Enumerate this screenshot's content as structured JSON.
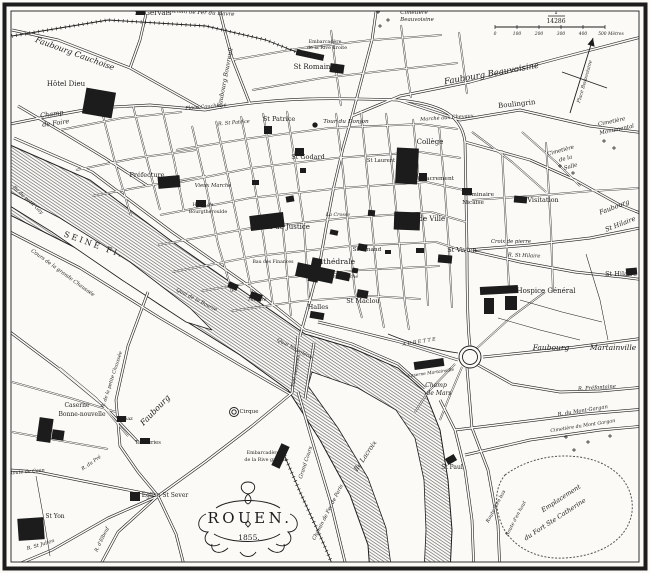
{
  "title": {
    "name": "ROUEN.",
    "year": "1855."
  },
  "scale": {
    "numerator": "1",
    "denominator": "14286",
    "ticks": [
      "0",
      "100",
      "200",
      "300",
      "400",
      "500 Mètres"
    ],
    "bar": {
      "x0": 495,
      "y": 27,
      "step": 22
    }
  },
  "colors": {
    "ink": "#1c1c1c",
    "paper": "#fbfaf6",
    "water_line": "#4a4a4a"
  },
  "compass": {
    "needle": "M570,113 L593,38",
    "cross": "M562,72 L607,88",
    "head": "M593,38 L594.6,46.7 L587.5,44.5 Z"
  },
  "river": {
    "main": "M10,145 L90,180 L170,240 L250,296 L305,334 L352,348 L398,368 L425,392 L440,430 L448,480 L452,530 L450,573 L370,573 L368,545 L350,495 L320,440 L288,390 L240,355 L160,305 L80,250 L10,215 Z",
    "islands": [
      "M312,372 L358,388 L396,410 L415,438 L424,480 L426,530 L424,573 L392,573 L386,528 L368,478 L338,428 L308,386 Z",
      "M10,192 L60,218 L130,262 L190,308 L212,330 L186,322 L122,280 L52,232 L10,206 Z"
    ],
    "aubette": "M388,334 C412,344 436,350 458,353"
  },
  "roads": {
    "major": [
      "M14,138 L92,172 L172,232 L252,288 L305,330 L352,344 L398,364 L425,388",
      "M10,232 L80,268 L160,318 L240,365 L290,394",
      "M10,124 L40,118 L95,108 L150,105 L205,110",
      "M205,110 L130,68 L58,40 L12,30",
      "M130,68 L140,40 L146,14",
      "M205,110 C280,96 340,98 398,100 C442,104 462,116 465,142 L467,250 C467,300 468,332 470,346",
      "M300,336 L310,300 L320,262 L326,228 L334,186 L343,148 L352,116 L362,78 L372,40 L376,12",
      "M250,104 L232,58 L224,28 L220,12",
      "M352,116 L400,96 L470,82 L560,58 L645,36",
      "M398,100 L460,120 L520,110 L590,126 L645,133",
      "M465,142 L530,160 L575,180 L620,205 L645,215",
      "M467,250 L530,245 L590,238 L625,231 L645,227",
      "M467,250 L520,262 L575,272 L622,277 L645,280",
      "M483,357 L560,349 L645,338",
      "M458,360 L400,342 L352,330 L318,322",
      "M478,365 L512,384 L560,392 L600,391 L645,387",
      "M440,400 L455,430 L465,470 L472,520 L474,573",
      "M467,368 L472,428 L488,470 L498,525 L500,573",
      "M455,430 L520,422 L585,414 L645,409",
      "M465,455 L530,440 L600,430 L645,426",
      "M298,336 L292,393",
      "M314,343 L305,399",
      "M292,393 L252,426 L205,462 L158,496",
      "M158,496 L118,532 L96,573",
      "M158,496 L108,518 L52,550 L14,566",
      "M158,496 L98,484 L38,472 L10,470",
      "M158,496 L176,534 L186,573",
      "M298,392 L312,440 L330,500 L344,558 L348,573",
      "M148,292 L128,346 L116,400 L120,446 L138,472 L158,496",
      "M10,332 L58,368 L104,406 L138,442",
      "M18,106 L62,132 L105,158 L148,186"
    ],
    "minor": [
      "M192,126 L206,186 L218,244 L232,292",
      "M216,121 L229,181 L241,239 L253,299",
      "M241,116 L253,176 L263,234 L273,306",
      "M263,113 L273,171 L283,229 L291,316",
      "M287,111 L296,169 L304,227 L309,300",
      "M336,113 L343,171 L349,235 L355,292 L362,318",
      "M361,111 L367,171 L373,235 L379,300 L384,328",
      "M386,113 L393,176 L399,240 L405,304 L409,330",
      "M413,119 L419,181 L425,245 L428,306",
      "M439,126 L445,190 L449,250 L452,308",
      "M176,150 L252,138 L330,128 L420,124 L458,129",
      "M166,185 L251,168 L336,158 L420,152 L461,158",
      "M160,215 L250,198 L341,188 L426,182 L464,190",
      "M158,245 L251,228 L346,218 L431,212 L466,222",
      "M172,272 L256,256 L350,246 L436,242 L467,252",
      "M201,291 L281,278 L361,270 L440,266",
      "M231,311 L301,301 L371,296 L421,299",
      "M60,130 L122,118 L182,112",
      "M76,170 L136,158 L196,150",
      "M92,196 L152,185 L206,176",
      "M102,112 L116,166 L131,216",
      "M133,106 L147,160 L160,210",
      "M162,108 L174,160 L184,212",
      "M472,200 L532,196 L592,191 L640,188",
      "M502,150 L506,230 L509,288",
      "M546,142 L551,230 L553,292",
      "M232,60 L302,48 L372,40 L442,35",
      "M252,90 L322,78 L392,70 L458,63",
      "M331,30 L336,70 L341,106",
      "M401,25 L406,65 L411,98",
      "M459,32 L464,70 L467,94",
      "M472,132 L512,162 L546,192",
      "M522,132 L556,162 L580,186",
      "M12,382 L70,398 L116,412",
      "M12,432 L62,441 L108,449",
      "M60,368 L96,398 L128,436",
      "M462,367 L448,400 L440,420",
      "M455,364 L428,392 L415,412",
      "M476,349 L510,318 L545,292"
    ],
    "lane": [
      "M498,318 L540,330 L580,340",
      "M520,300 L562,312 L602,322",
      "M586,254 L600,300 L608,340",
      "M36,476 L44,520 L50,556"
    ]
  },
  "rails": [
    "M12,36 L108,20 L206,26 L266,40 L304,55",
    "M283,452 L300,492 L322,540 L336,573"
  ],
  "buildings": [
    [
      84,
      90,
      30,
      26,
      10
    ],
    [
      136,
      8,
      9,
      7,
      0
    ],
    [
      330,
      64,
      14,
      9,
      8
    ],
    [
      296,
      52,
      28,
      6,
      12
    ],
    [
      396,
      148,
      22,
      36,
      3
    ],
    [
      394,
      212,
      26,
      18,
      2
    ],
    [
      419,
      173,
      8,
      8,
      0
    ],
    [
      250,
      214,
      34,
      15,
      -7
    ],
    [
      296,
      266,
      38,
      14,
      12
    ],
    [
      310,
      258,
      10,
      24,
      12
    ],
    [
      336,
      272,
      14,
      8,
      12
    ],
    [
      357,
      290,
      11,
      8,
      10
    ],
    [
      295,
      148,
      9,
      8,
      0
    ],
    [
      264,
      126,
      8,
      8,
      0
    ],
    [
      158,
      176,
      22,
      12,
      -5
    ],
    [
      196,
      200,
      10,
      7,
      0
    ],
    [
      438,
      255,
      14,
      8,
      5
    ],
    [
      514,
      196,
      13,
      7,
      5
    ],
    [
      462,
      188,
      10,
      7,
      0
    ],
    [
      480,
      286,
      38,
      8,
      -3
    ],
    [
      484,
      298,
      10,
      16,
      0
    ],
    [
      505,
      296,
      12,
      14,
      0
    ],
    [
      626,
      268,
      11,
      7,
      -5
    ],
    [
      414,
      360,
      30,
      8,
      -8
    ],
    [
      38,
      418,
      14,
      24,
      8
    ],
    [
      52,
      430,
      12,
      10,
      8
    ],
    [
      130,
      492,
      10,
      9,
      0
    ],
    [
      18,
      518,
      26,
      22,
      -4
    ],
    [
      446,
      456,
      10,
      7,
      -30
    ],
    [
      276,
      444,
      9,
      24,
      25
    ],
    [
      117,
      416,
      9,
      6,
      0
    ],
    [
      140,
      438,
      10,
      6,
      0
    ],
    [
      250,
      293,
      12,
      7,
      20
    ],
    [
      228,
      283,
      10,
      6,
      25
    ],
    [
      310,
      312,
      14,
      7,
      10
    ],
    [
      358,
      244,
      9,
      7,
      10
    ],
    [
      286,
      196,
      8,
      6,
      -10
    ],
    [
      252,
      180,
      7,
      5,
      0
    ],
    [
      330,
      230,
      8,
      5,
      12
    ],
    [
      300,
      168,
      6,
      5,
      0
    ],
    [
      368,
      210,
      7,
      6,
      5
    ],
    [
      416,
      248,
      8,
      5,
      0
    ],
    [
      352,
      268,
      6,
      5,
      10
    ],
    [
      385,
      250,
      6,
      4,
      0
    ]
  ],
  "circles": [
    {
      "cx": 234,
      "cy": 412,
      "r": 4.5
    },
    {
      "cx": 234,
      "cy": 412,
      "r": 2.2
    },
    {
      "cx": 470,
      "cy": 357,
      "r": 11
    },
    {
      "cx": 470,
      "cy": 357,
      "r": 7.5
    },
    {
      "cx": 315,
      "cy": 125,
      "r": 2.2,
      "solid": 1
    }
  ],
  "crosses": [
    [
      378,
      12
    ],
    [
      388,
      20
    ],
    [
      380,
      26
    ],
    [
      393,
      9
    ],
    [
      560,
      166
    ],
    [
      573,
      173
    ],
    [
      604,
      141
    ],
    [
      614,
      148
    ],
    [
      566,
      437
    ],
    [
      588,
      442
    ],
    [
      610,
      436
    ],
    [
      574,
      450
    ]
  ],
  "labels": [
    {
      "t": "St Gervais",
      "x": 153,
      "y": 15,
      "f": 7
    },
    {
      "t": "Chemin de Fer du Havre",
      "x": 200,
      "y": 14,
      "f": 5.5,
      "i": 1,
      "r": 3
    },
    {
      "t": "Faubourg Cauchoise",
      "x": 74,
      "y": 56,
      "f": 8,
      "i": 1,
      "r": 20
    },
    {
      "t": "Hôtel Dieu",
      "x": 66,
      "y": 86,
      "f": 7
    },
    {
      "t": "Champ",
      "x": 52,
      "y": 116,
      "f": 6.5,
      "i": 1,
      "r": -8
    },
    {
      "t": "de Foire",
      "x": 56,
      "y": 125,
      "f": 6.5,
      "i": 1,
      "r": -8
    },
    {
      "t": "Place Cauchoise",
      "x": 206,
      "y": 108,
      "f": 5,
      "i": 1,
      "r": -5
    },
    {
      "t": "Faubourg Bouvreuil",
      "x": 227,
      "y": 78,
      "f": 6,
      "i": 1,
      "r": -79
    },
    {
      "t": "St Romain",
      "x": 312,
      "y": 69,
      "f": 7
    },
    {
      "t": "Embarcadère",
      "x": 325,
      "y": 43,
      "f": 4.8
    },
    {
      "t": "de la Rive droite",
      "x": 327,
      "y": 49,
      "f": 4.8
    },
    {
      "t": "Cimetière",
      "x": 414,
      "y": 14,
      "f": 5.5,
      "i": 1
    },
    {
      "t": "Beauvoisine",
      "x": 417,
      "y": 21,
      "f": 5.5,
      "i": 1
    },
    {
      "t": "Faubourg Beauvoisine",
      "x": 492,
      "y": 76,
      "f": 8.5,
      "i": 1,
      "r": -10
    },
    {
      "t": "Boulingrin",
      "x": 517,
      "y": 106,
      "f": 7,
      "r": -6
    },
    {
      "t": "Marché aux Chevaux",
      "x": 447,
      "y": 119,
      "f": 5,
      "i": 1,
      "r": -4
    },
    {
      "t": "Cimetière",
      "x": 612,
      "y": 123,
      "f": 5.5,
      "i": 1,
      "r": -12
    },
    {
      "t": "Monumental",
      "x": 617,
      "y": 131,
      "f": 5.5,
      "i": 1,
      "r": -12
    },
    {
      "t": "Place Beauvoisine",
      "x": 586,
      "y": 82,
      "f": 4.8,
      "i": 1,
      "r": -74
    },
    {
      "t": "Cimetière",
      "x": 561,
      "y": 152,
      "f": 5.5,
      "i": 1,
      "r": -15
    },
    {
      "t": "de la",
      "x": 566,
      "y": 160,
      "f": 5.5,
      "i": 1,
      "r": -15
    },
    {
      "t": "Salle",
      "x": 571,
      "y": 168,
      "f": 5.5,
      "i": 1,
      "r": -15
    },
    {
      "t": "Faubourg",
      "x": 615,
      "y": 209,
      "f": 6.5,
      "i": 1,
      "r": -21
    },
    {
      "t": "St Hilaire",
      "x": 621,
      "y": 226,
      "f": 6.5,
      "i": 1,
      "r": -21
    },
    {
      "t": "St Hilaire",
      "x": 621,
      "y": 276,
      "f": 6.5
    },
    {
      "t": "Collège",
      "x": 430,
      "y": 144,
      "f": 7
    },
    {
      "t": "St Sacrement",
      "x": 434,
      "y": 180,
      "f": 5.8
    },
    {
      "t": "Séminaire",
      "x": 479,
      "y": 196,
      "f": 5.8
    },
    {
      "t": "Nicaise",
      "x": 473,
      "y": 204,
      "f": 5.8
    },
    {
      "t": "Visitation",
      "x": 543,
      "y": 202,
      "f": 6.5
    },
    {
      "t": "Hôtel de Ville",
      "x": 421,
      "y": 221,
      "f": 7
    },
    {
      "t": "St Laurent",
      "x": 381,
      "y": 162,
      "f": 5.2
    },
    {
      "t": "Tour du Donjon",
      "x": 346,
      "y": 123,
      "f": 5.8,
      "i": 1
    },
    {
      "t": "St Patrice",
      "x": 279,
      "y": 121,
      "f": 6.5
    },
    {
      "t": "R. St Patrice",
      "x": 234,
      "y": 124,
      "f": 5,
      "i": 1,
      "r": -5
    },
    {
      "t": "St Godard",
      "x": 308,
      "y": 159,
      "f": 6.5
    },
    {
      "t": "Préfecture",
      "x": 147,
      "y": 177,
      "f": 6.5
    },
    {
      "t": "Hôtel du",
      "x": 203,
      "y": 206,
      "f": 4.8
    },
    {
      "t": "Bourgtheroulde",
      "x": 208,
      "y": 213,
      "f": 4.8
    },
    {
      "t": "Vieux Marché",
      "x": 213,
      "y": 187,
      "f": 5.2,
      "i": 1
    },
    {
      "t": "Palais de Justice",
      "x": 281,
      "y": 229,
      "f": 7
    },
    {
      "t": "Bau des Finances",
      "x": 273,
      "y": 263,
      "f": 4.6
    },
    {
      "t": "La Crosse",
      "x": 338,
      "y": 216,
      "f": 4.8,
      "i": 1
    },
    {
      "t": "Cathédrale",
      "x": 334,
      "y": 264,
      "f": 7.5
    },
    {
      "t": "Archevêché",
      "x": 344,
      "y": 278,
      "f": 4.8,
      "i": 1
    },
    {
      "t": "St Amand",
      "x": 367,
      "y": 251,
      "f": 5.8
    },
    {
      "t": "Halles",
      "x": 318,
      "y": 309,
      "f": 6.5
    },
    {
      "t": "St Maclou",
      "x": 363,
      "y": 303,
      "f": 6.5
    },
    {
      "t": "Théâtre",
      "x": 257,
      "y": 301,
      "f": 4.8,
      "i": 1
    },
    {
      "t": "Quai de la Bourse",
      "x": 196,
      "y": 301,
      "f": 5,
      "i": 1,
      "r": 27
    },
    {
      "t": "Croix de pierre",
      "x": 511,
      "y": 243,
      "f": 5.2,
      "i": 1
    },
    {
      "t": "R. St Hilaire",
      "x": 524,
      "y": 257,
      "f": 5.2,
      "i": 1,
      "r": 2
    },
    {
      "t": "St Vivien",
      "x": 462,
      "y": 252,
      "f": 6.5
    },
    {
      "t": "Hospice Général",
      "x": 546,
      "y": 293,
      "f": 7
    },
    {
      "t": "SEINE Fl.",
      "x": 93,
      "y": 247,
      "f": 8,
      "r": 20,
      "s": 2.5
    },
    {
      "t": "Cours de la grande Chaussée",
      "x": 62,
      "y": 274,
      "f": 5.2,
      "i": 1,
      "r": 36
    },
    {
      "t": "Ile du petit Gay",
      "x": 27,
      "y": 201,
      "f": 5,
      "i": 1,
      "r": 42
    },
    {
      "t": "Quai Napoléon",
      "x": 294,
      "y": 350,
      "f": 5.2,
      "i": 1,
      "r": 28
    },
    {
      "t": "Pont suspendu",
      "x": 297,
      "y": 371,
      "f": 4.4,
      "i": 1,
      "r": -80
    },
    {
      "t": "Cirque",
      "x": 249,
      "y": 413,
      "f": 5.5
    },
    {
      "t": "Caserne",
      "x": 77,
      "y": 407,
      "f": 6
    },
    {
      "t": "Bonne-nouvelle",
      "x": 82,
      "y": 416,
      "f": 6
    },
    {
      "t": "Faubourg",
      "x": 157,
      "y": 412,
      "f": 8,
      "i": 1,
      "r": -46
    },
    {
      "t": "Gaz",
      "x": 128,
      "y": 420,
      "f": 5
    },
    {
      "t": "Tanneries",
      "x": 148,
      "y": 444,
      "f": 5.2
    },
    {
      "t": "R. de la petite Chaussée",
      "x": 113,
      "y": 380,
      "f": 4.8,
      "i": 1,
      "r": -72
    },
    {
      "t": "Église St Sever",
      "x": 165,
      "y": 497,
      "f": 6
    },
    {
      "t": "St Yon",
      "x": 55,
      "y": 518,
      "f": 6
    },
    {
      "t": "R. St Julien",
      "x": 41,
      "y": 546,
      "f": 5,
      "i": 1,
      "r": -17
    },
    {
      "t": "Route de Caen",
      "x": 27,
      "y": 473,
      "f": 4.8,
      "i": 1,
      "r": -5
    },
    {
      "t": "R. du Pré",
      "x": 92,
      "y": 464,
      "f": 4.8,
      "i": 1,
      "r": -35
    },
    {
      "t": "R. d'Elbeuf",
      "x": 103,
      "y": 540,
      "f": 4.8,
      "i": 1,
      "r": -64
    },
    {
      "t": "Embarcadère",
      "x": 263,
      "y": 454,
      "f": 4.8
    },
    {
      "t": "de la Rive gauche",
      "x": 266,
      "y": 461,
      "f": 4.8
    },
    {
      "t": "Grand Cours",
      "x": 307,
      "y": 463,
      "f": 5.2,
      "i": 1,
      "r": -72
    },
    {
      "t": "Chemin de Fer de Paris",
      "x": 329,
      "y": 513,
      "f": 5.2,
      "i": 1,
      "r": -63
    },
    {
      "t": "Ile Lacroix",
      "x": 367,
      "y": 457,
      "f": 6.5,
      "i": 1,
      "r": -56
    },
    {
      "t": "St Paul",
      "x": 452,
      "y": 469,
      "f": 6
    },
    {
      "t": "Emplacement",
      "x": 562,
      "y": 500,
      "f": 6.5,
      "i": 1,
      "r": -33
    },
    {
      "t": "du Fort Ste Catherine",
      "x": 556,
      "y": 521,
      "f": 6.5,
      "i": 1,
      "r": -33
    },
    {
      "t": "Route d'en bas",
      "x": 497,
      "y": 507,
      "f": 4.8,
      "i": 1,
      "r": -62
    },
    {
      "t": "Route d'en haut",
      "x": 517,
      "y": 519,
      "f": 4.8,
      "i": 1,
      "r": -62
    },
    {
      "t": "Faubourg",
      "x": 551,
      "y": 350,
      "f": 7.5,
      "i": 1
    },
    {
      "t": "Martainville",
      "x": 613,
      "y": 350,
      "f": 7.5,
      "i": 1
    },
    {
      "t": "R. Préfontaine",
      "x": 597,
      "y": 389,
      "f": 5.2,
      "i": 1,
      "r": -4
    },
    {
      "t": "R. du Mont-Gargan",
      "x": 583,
      "y": 412,
      "f": 5.2,
      "i": 1,
      "r": -9
    },
    {
      "t": "Cimetière du Mont Gargan",
      "x": 583,
      "y": 427,
      "f": 4.8,
      "i": 1,
      "r": -9
    },
    {
      "t": "Champ",
      "x": 436,
      "y": 387,
      "f": 6,
      "i": 1
    },
    {
      "t": "de Mars",
      "x": 439,
      "y": 395,
      "f": 6,
      "i": 1
    },
    {
      "t": "Caserne Martainville",
      "x": 431,
      "y": 374,
      "f": 4.4,
      "i": 1,
      "r": -8
    },
    {
      "t": "AUBETTE",
      "x": 420,
      "y": 343,
      "f": 4.8,
      "i": 1,
      "r": -9,
      "s": 1.5
    }
  ],
  "fort_outline": "M505,475 C525,460 555,452 585,458 C615,464 635,485 632,512 C628,540 600,556 565,558 C535,560 508,545 500,520 C494,502 496,486 505,475 Z",
  "flourishes": [
    "M248,494 c-9,-2 -9,-12 0,-12 c9,0 9,10 0,12",
    "M248,494 c-4,4 -4,8 0,10 c4,-2 4,-6 0,-10",
    "M206,514 c-10,4 -10,18 2,18 c-8,8 2,18 12,12",
    "M290,514 c10,4 10,18 -2,18 c8,8 -2,18 -12,12",
    "M216,508 C230,498 266,498 280,508",
    "M214,534 C230,544 266,544 280,534",
    "M228,548 c-8,8 -18,4 -16,-4",
    "M268,548 c8,8 18,4 16,-4",
    "M240,552 c4,6 12,6 16,0",
    "M245.5,524 l2.5,3 l2.5,-3 l-2.5,-3 Z"
  ]
}
